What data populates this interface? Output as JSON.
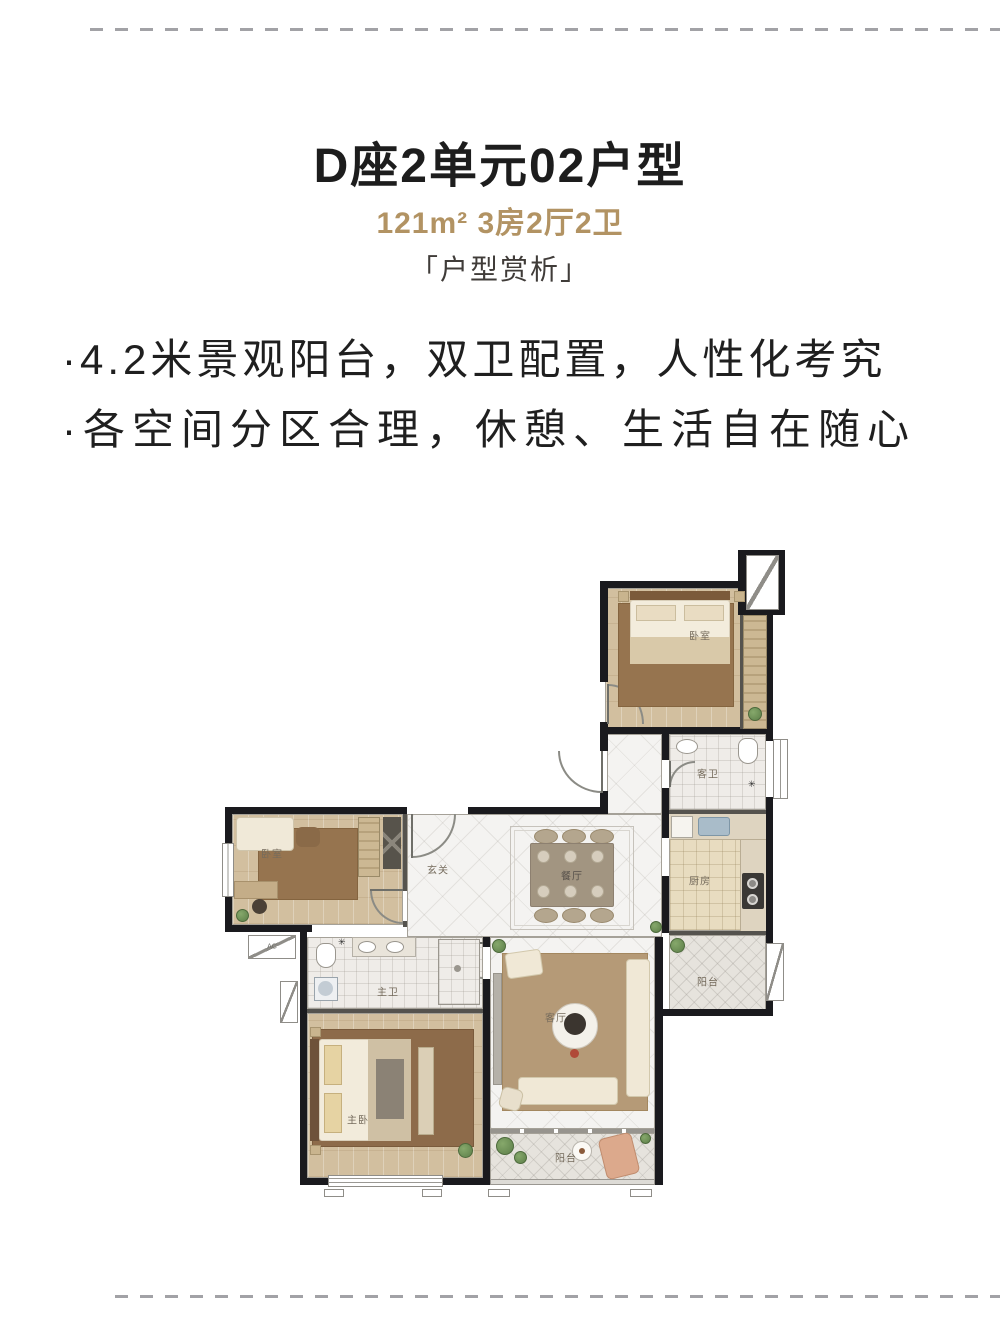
{
  "header": {
    "title": "D座2单元02户型",
    "subtitle": "121m² 3房2厅2卫",
    "tagline": "「户型赏析」"
  },
  "bullets": {
    "line1": "·4.2米景观阳台，双卫配置，人性化考究",
    "line2": "·各空间分区合理，休憩、生活自在随心"
  },
  "floorplan": {
    "rooms": {
      "bedroom_top_right": "卧室",
      "guest_bath": "客卫",
      "kitchen": "厨房",
      "balcony_right": "阳台",
      "bedroom_left": "卧室",
      "foyer": "玄关",
      "dining": "餐厅",
      "master_bath": "主卫",
      "master_bedroom": "主卧",
      "living_room": "客厅",
      "balcony_bottom": "阳台"
    },
    "annotations": {
      "ac_platform": "AC"
    }
  },
  "colors": {
    "accent_gold": "#b29363",
    "title_text": "#1d1d1d",
    "wall": "#1a1a1e"
  }
}
